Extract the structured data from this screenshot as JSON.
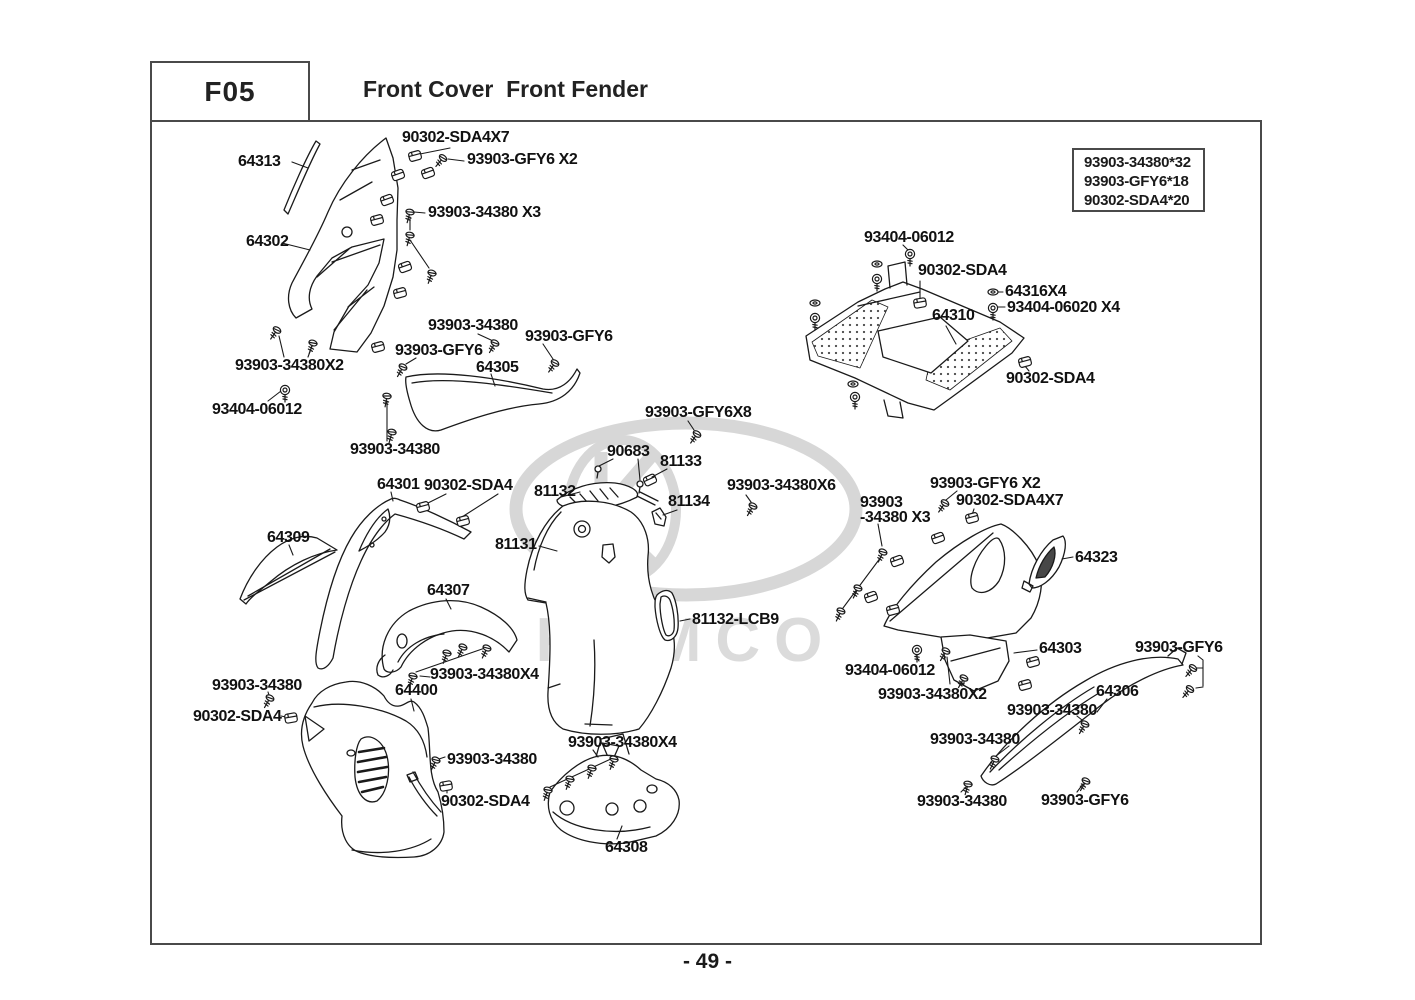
{
  "header": {
    "code": "F05",
    "title": "Front Cover  Front Fender"
  },
  "ref_box": {
    "lines": [
      "93903-34380*32",
      "93903-GFY6*18",
      "90302-SDA4*20"
    ]
  },
  "watermark": {
    "brand": "KYMCO"
  },
  "page_number": "- 49 -",
  "parts_labels": [
    {
      "text": "90302-SDA4X7",
      "x": 402,
      "y": 130
    },
    {
      "text": "93903-GFY6 X2",
      "x": 467,
      "y": 152
    },
    {
      "text": "64313",
      "x": 238,
      "y": 154
    },
    {
      "text": "93903-34380 X3",
      "x": 428,
      "y": 205
    },
    {
      "text": "64302",
      "x": 246,
      "y": 234
    },
    {
      "text": "93404-06012",
      "x": 864,
      "y": 230
    },
    {
      "text": "90302-SDA4",
      "x": 918,
      "y": 263
    },
    {
      "text": "64316X4",
      "x": 1005,
      "y": 284
    },
    {
      "text": "93404-06020 X4",
      "x": 1007,
      "y": 300
    },
    {
      "text": "64310",
      "x": 932,
      "y": 308
    },
    {
      "text": "90302-SDA4",
      "x": 1006,
      "y": 371
    },
    {
      "text": "93903-34380",
      "x": 428,
      "y": 318
    },
    {
      "text": "93903-GFY6",
      "x": 525,
      "y": 329
    },
    {
      "text": "93903-GFY6",
      "x": 395,
      "y": 343
    },
    {
      "text": "64305",
      "x": 476,
      "y": 360
    },
    {
      "text": "93903-34380X2",
      "x": 235,
      "y": 358
    },
    {
      "text": "93404-06012",
      "x": 212,
      "y": 402
    },
    {
      "text": "93903-34380",
      "x": 350,
      "y": 442
    },
    {
      "text": "93903-GFY6X8",
      "x": 645,
      "y": 405
    },
    {
      "text": "90683",
      "x": 607,
      "y": 444
    },
    {
      "text": "81133",
      "x": 660,
      "y": 454
    },
    {
      "text": "81132",
      "x": 534,
      "y": 484
    },
    {
      "text": "81134",
      "x": 668,
      "y": 494
    },
    {
      "text": "93903-34380X6",
      "x": 727,
      "y": 478
    },
    {
      "text": "64301",
      "x": 377,
      "y": 477
    },
    {
      "text": "90302-SDA4",
      "x": 424,
      "y": 478
    },
    {
      "text": "64309",
      "x": 267,
      "y": 530
    },
    {
      "text": "81131",
      "x": 495,
      "y": 537
    },
    {
      "text": "64307",
      "x": 427,
      "y": 583
    },
    {
      "text": "93903-GFY6 X2",
      "x": 930,
      "y": 476
    },
    {
      "text": "93903\n-34380 X3",
      "x": 860,
      "y": 495
    },
    {
      "text": "90302-SDA4X7",
      "x": 956,
      "y": 493
    },
    {
      "text": "64323",
      "x": 1075,
      "y": 550
    },
    {
      "text": "81132-LCB9",
      "x": 692,
      "y": 612
    },
    {
      "text": "64303",
      "x": 1039,
      "y": 641
    },
    {
      "text": "93903-GFY6",
      "x": 1135,
      "y": 640
    },
    {
      "text": "93404-06012",
      "x": 845,
      "y": 663
    },
    {
      "text": "93903-34380X2",
      "x": 878,
      "y": 687
    },
    {
      "text": "64306",
      "x": 1096,
      "y": 684
    },
    {
      "text": "93903-34380",
      "x": 1007,
      "y": 703
    },
    {
      "text": "93903-34380",
      "x": 930,
      "y": 732
    },
    {
      "text": "93903-34380",
      "x": 917,
      "y": 794
    },
    {
      "text": "93903-GFY6",
      "x": 1041,
      "y": 793
    },
    {
      "text": "93903-34380",
      "x": 212,
      "y": 678
    },
    {
      "text": "90302-SDA4",
      "x": 193,
      "y": 709
    },
    {
      "text": "64400",
      "x": 395,
      "y": 683
    },
    {
      "text": "93903-34380X4",
      "x": 430,
      "y": 667
    },
    {
      "text": "93903-34380",
      "x": 447,
      "y": 752
    },
    {
      "text": "90302-SDA4",
      "x": 441,
      "y": 794
    },
    {
      "text": "93903-34380X4",
      "x": 568,
      "y": 735
    },
    {
      "text": "64308",
      "x": 605,
      "y": 840
    }
  ]
}
